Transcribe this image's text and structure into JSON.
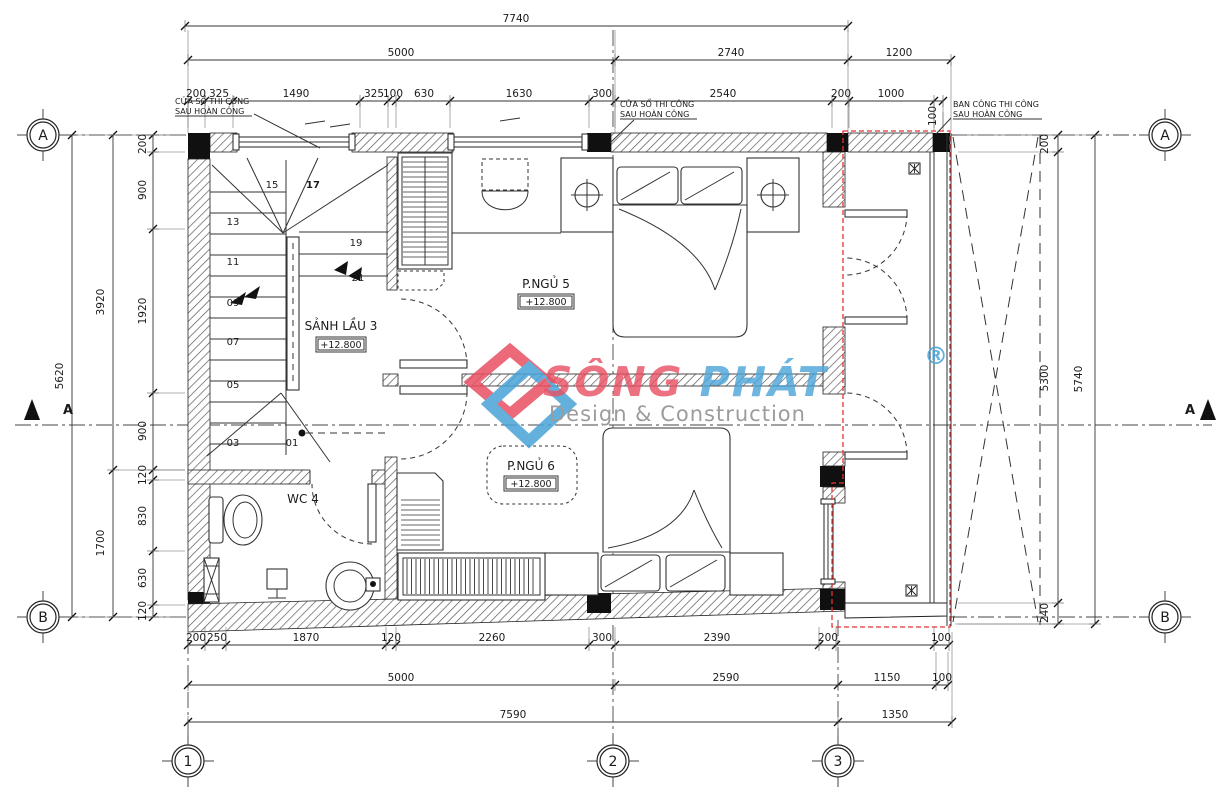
{
  "logo": {
    "part1": "SÔNG",
    "part2": "PHÁT",
    "reg": "®",
    "tagline": "Design & Construction",
    "red": "#e85062",
    "blue": "#4aa3d8",
    "gray": "#9c9c9c"
  },
  "notes": {
    "win_left": {
      "l1": "CỬA SỔ THI CÔNG",
      "l2": "SAU HOÀN CÔNG"
    },
    "win_mid": {
      "l1": "CỬA SỔ THI CÔNG",
      "l2": "SAU HOÀN CÔNG"
    },
    "balcony": {
      "l1": "BAN CÔNG THI CÔNG",
      "l2": "SAU HOÀN CÔNG"
    }
  },
  "rooms": {
    "bedroom5": {
      "name": "P.NGỦ 5",
      "level": "+12.800"
    },
    "bedroom6": {
      "name": "P.NGỦ 6",
      "level": "+12.800"
    },
    "hall": {
      "name": "SẢNH LẦU 3",
      "level": "+12.800"
    },
    "wc": {
      "name": "WC 4"
    }
  },
  "stairs": {
    "steps": [
      "01",
      "03",
      "05",
      "07",
      "09",
      "11",
      "13",
      "15",
      "17",
      "19",
      "21"
    ]
  },
  "grid": {
    "row_a": "A",
    "row_b": "B",
    "col_1": "1",
    "col_2": "2",
    "col_3": "3",
    "section": "A"
  },
  "dims": {
    "top": {
      "overall": "7740",
      "spans": [
        "5000",
        "2740",
        "1200"
      ],
      "detail": [
        "200",
        "325",
        "1490",
        "325",
        "100",
        "630",
        "1630",
        "300",
        "2540",
        "200",
        "1000",
        "100"
      ]
    },
    "bottom": {
      "detail": [
        "200",
        "250",
        "1870",
        "120",
        "2260",
        "300",
        "2390",
        "200",
        "100"
      ],
      "spans": [
        "5000",
        "2590",
        "1150",
        "100"
      ],
      "overall": [
        "7590",
        "1350"
      ]
    },
    "left": {
      "overall": "5620",
      "spans": [
        "3920",
        "1700"
      ],
      "detail": [
        "200",
        "900",
        "1920",
        "900",
        "120",
        "830",
        "630",
        "120"
      ]
    },
    "right": {
      "detail": [
        "200",
        "5300",
        "240"
      ],
      "overall": "5740"
    }
  }
}
